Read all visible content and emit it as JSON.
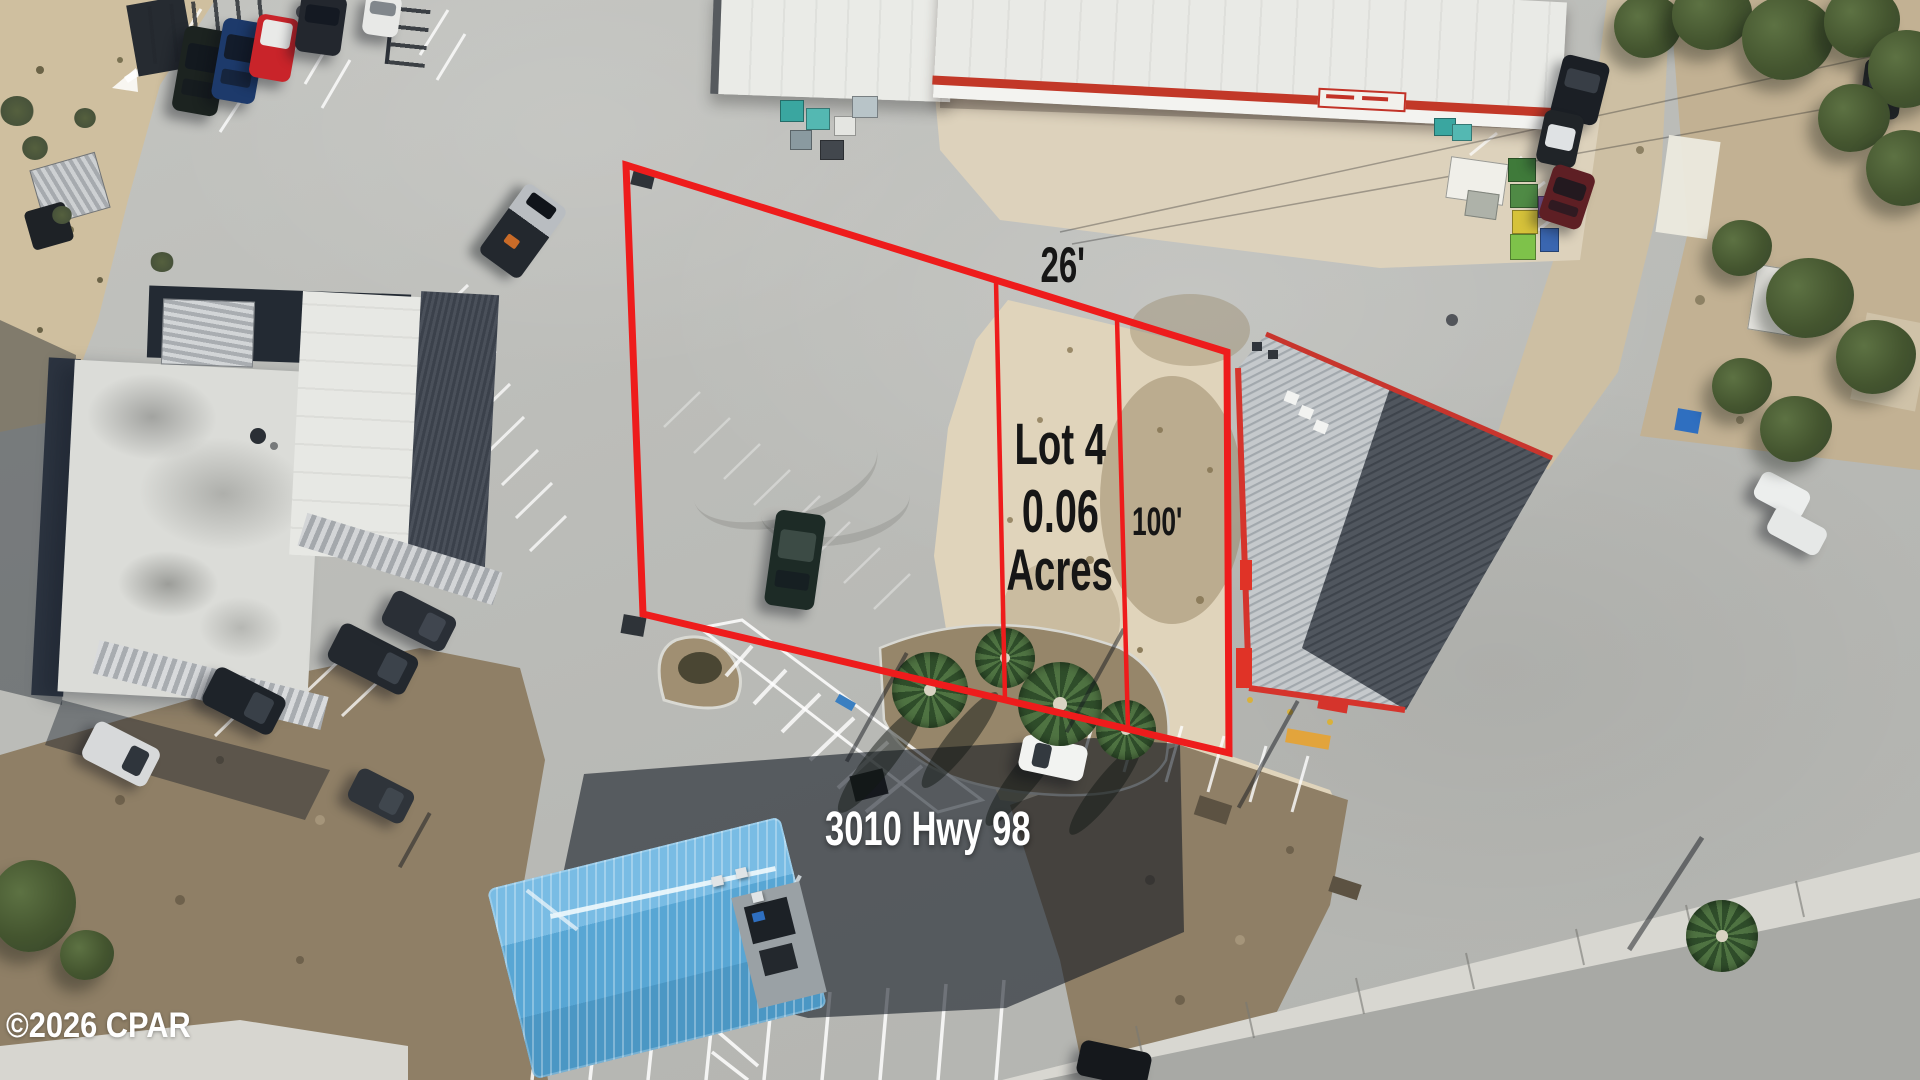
{
  "labels": {
    "frontage_dimension": "26'",
    "depth_dimension": "100'",
    "lot_name": "Lot 4",
    "lot_size_value": "0.06",
    "lot_size_unit": "Acres",
    "address": "3010 Hwy 98",
    "watermark": "©2026 CPAR"
  },
  "colors": {
    "lot_outline": "#ee1c1c",
    "dimension_text": "#161616",
    "address_text": "#ffffff",
    "watermark_text": "#ffffff",
    "sand": "#e0d4bb",
    "pavement": "#bcbdb9",
    "blue_roof": "#58a6d4"
  }
}
